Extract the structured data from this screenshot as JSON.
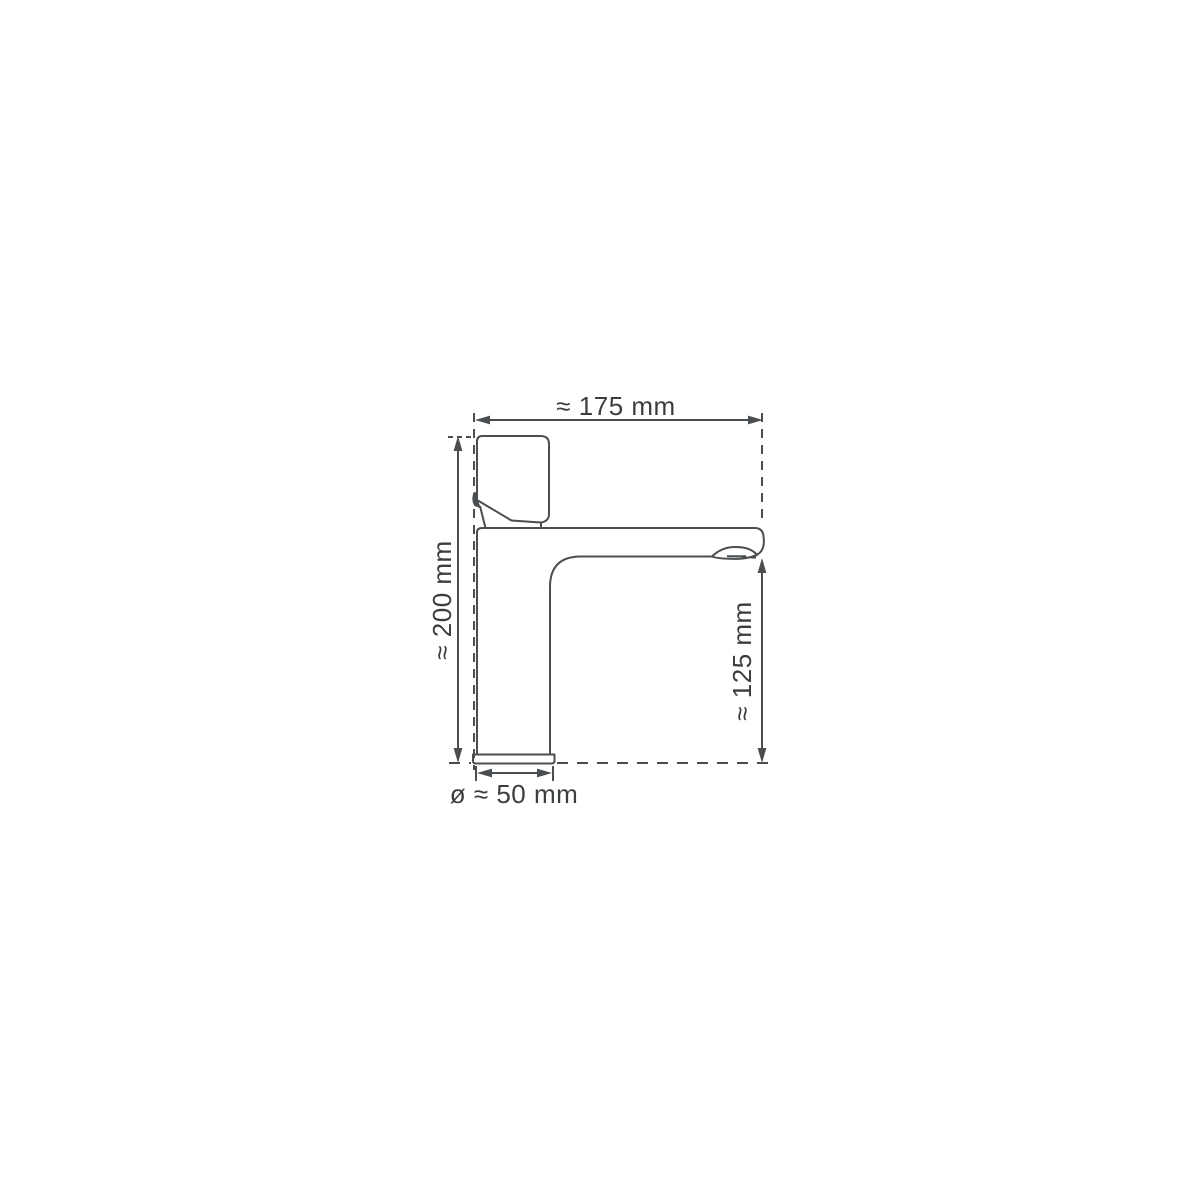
{
  "drawing": {
    "colors": {
      "line": "#4a4e51",
      "text": "#3a3e41",
      "background": "#ffffff"
    },
    "labels": {
      "width": "≈ 175 mm",
      "height": "≈ 200 mm",
      "spout_height": "≈ 125 mm",
      "base_diameter": "ø ≈ 50 mm"
    },
    "values_mm": {
      "width": 175,
      "height": 200,
      "spout_height": 125,
      "base_diameter": 50
    },
    "approx_symbol": "≈",
    "diameter_symbol": "ø"
  }
}
